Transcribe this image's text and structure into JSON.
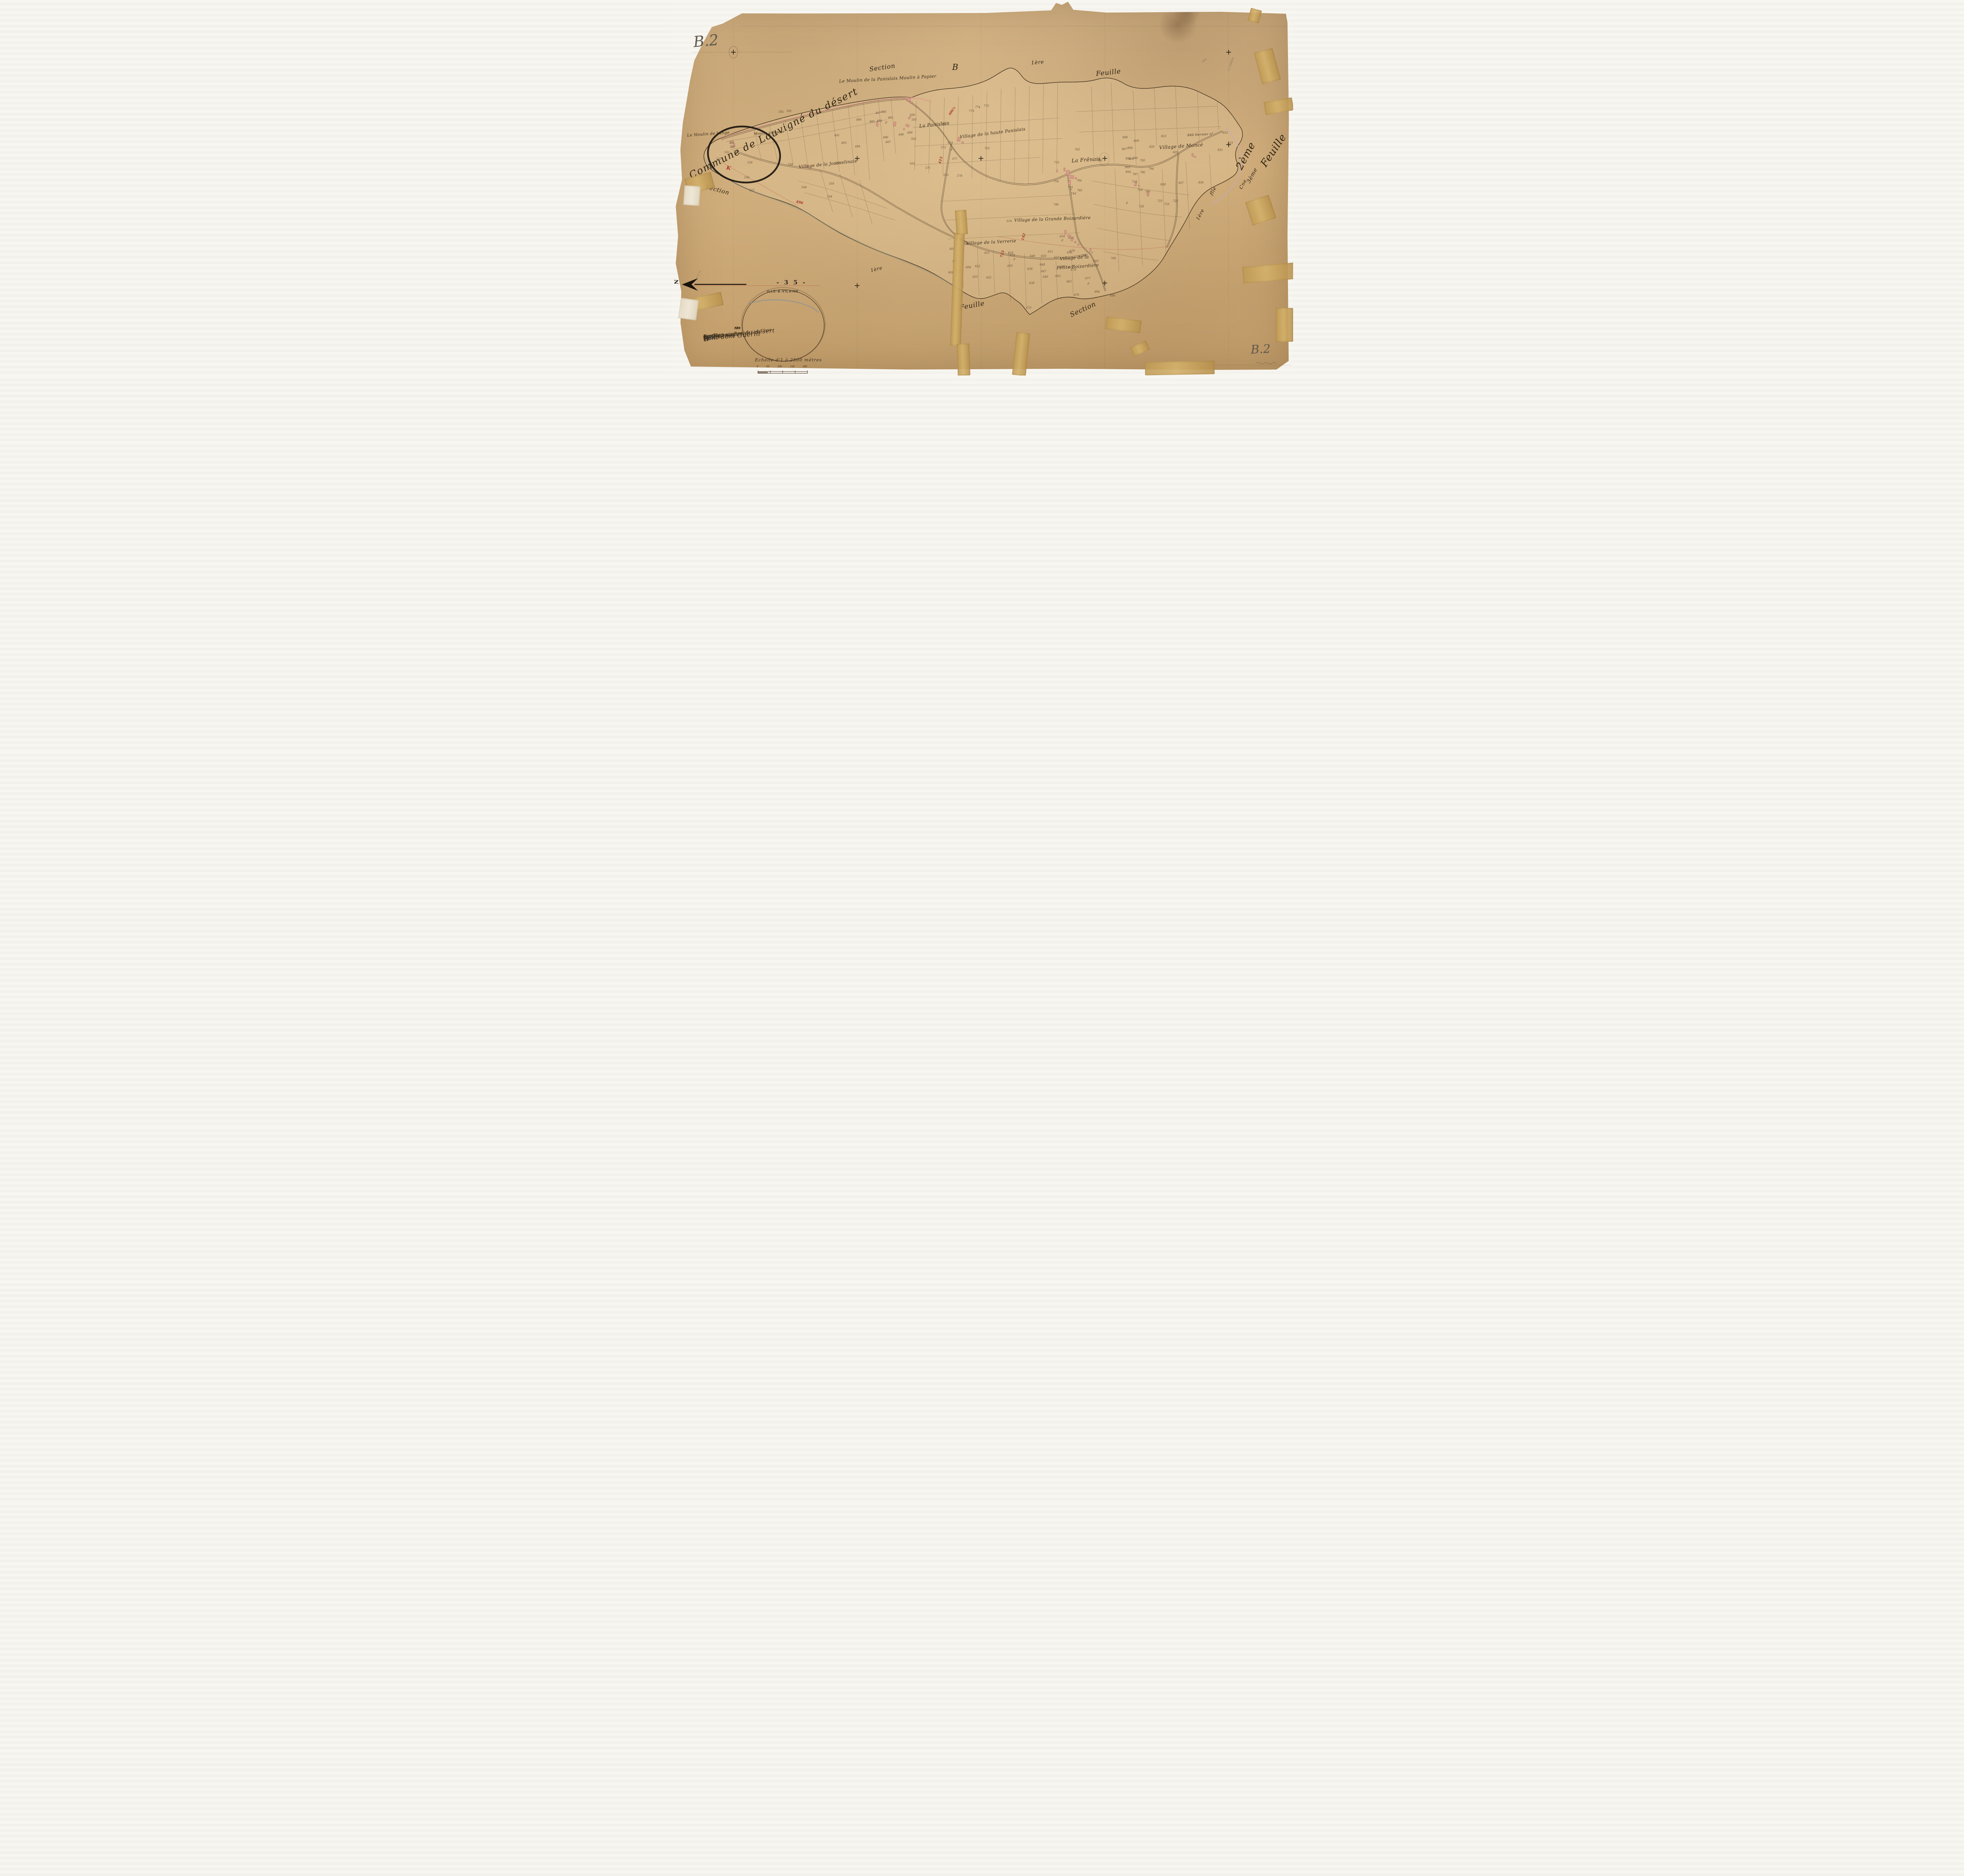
{
  "page": {
    "sheet_label_topleft": "B.2",
    "sheet_label_bottomright": "B.2",
    "archive_number": "- 3 5 -",
    "department_stamp": "ILLE-&-VILAINE",
    "north_label": "N"
  },
  "titles": {
    "commune": "Commune de Louvigné du désert"
  },
  "flourishes": [
    {
      "text": "Section",
      "x": 31.9,
      "y": 16.9,
      "rot": -8,
      "size": 16
    },
    {
      "text": "B",
      "x": 45.2,
      "y": 16.6,
      "rot": 0,
      "size": 21
    },
    {
      "text": "1ère",
      "x": 57.9,
      "y": 15.9,
      "rot": -5,
      "size": 13
    },
    {
      "text": "Feuille",
      "x": 68.3,
      "y": 18.3,
      "rot": -6,
      "size": 17
    },
    {
      "text": "Section",
      "x": 5.5,
      "y": 49.6,
      "rot": 15,
      "size": 15
    },
    {
      "text": "1ère",
      "x": 32.1,
      "y": 70.9,
      "rot": -14,
      "size": 12
    },
    {
      "text": "Feuille",
      "x": 46.4,
      "y": 80.3,
      "rot": -10,
      "size": 17
    },
    {
      "text": "Section",
      "x": 64.0,
      "y": 81.4,
      "rot": -25,
      "size": 17
    },
    {
      "text": "2ème",
      "x": 90.0,
      "y": 40.0,
      "rot": -62,
      "size": 26
    },
    {
      "text": "Feuille",
      "x": 93.9,
      "y": 38.5,
      "rot": -56,
      "size": 26
    },
    {
      "text": "3ème",
      "x": 92.1,
      "y": 45.9,
      "rot": -62,
      "size": 14
    },
    {
      "text": "Cne",
      "x": 91.1,
      "y": 48.3,
      "rot": -62,
      "size": 12
    },
    {
      "text": "1ère",
      "x": 84.1,
      "y": 56.4,
      "rot": -62,
      "size": 12
    },
    {
      "text": "flle",
      "x": 86.4,
      "y": 50.1,
      "rot": -62,
      "size": 12
    }
  ],
  "cartouche": {
    "commune": "La Bazouges du désert",
    "section_word": "Section",
    "section_letter": "B",
    "section_number": "2",
    "dite": "dite du",
    "name": "Pont dom Guérin",
    "feuilles": "En deux feuilles",
    "flle": "2ème flle",
    "range": "du N° 485 au N° 840",
    "author": "Par M. Declaye Gtre de 1ère Clsse",
    "scale_text": "Echelle d'1 à 2500 mètres",
    "scale_ticks": [
      "0",
      "50",
      "100",
      "150",
      "200"
    ]
  },
  "margin_list": {
    "header": "N°s B.",
    "values": [
      "508",
      "539",
      "616",
      "828"
    ]
  },
  "map": {
    "region_labels": [
      {
        "text": "Le Moulin de la Panislais Moulin à Papier",
        "x": 27.0,
        "y": 20.3,
        "rot": -3,
        "size": 11
      },
      {
        "text": "Le Moulin de Lange",
        "x": 2.6,
        "y": 35.1,
        "rot": -4,
        "size": 10
      },
      {
        "text": "Moulin à Papier",
        "x": 13.3,
        "y": 34.9,
        "rot": -4,
        "size": 9
      },
      {
        "text": "La Panislais",
        "x": 39.9,
        "y": 32.4,
        "rot": -6,
        "size": 12
      },
      {
        "text": "Village de la haute Panislais",
        "x": 46.4,
        "y": 34.7,
        "rot": -7,
        "size": 11
      },
      {
        "text": "Village de la Jousselinais",
        "x": 20.5,
        "y": 43.0,
        "rot": -6,
        "size": 11
      },
      {
        "text": "Village de la Verrerie",
        "x": 47.5,
        "y": 63.8,
        "rot": -3,
        "size": 11
      },
      {
        "text": "Village de la Grande Boizardière",
        "x": 55.2,
        "y": 57.6,
        "rot": -2,
        "size": 11
      },
      {
        "text": "Village de la",
        "x": 62.5,
        "y": 68.0,
        "rot": -4,
        "size": 11
      },
      {
        "text": "Petite Boizardière",
        "x": 62.0,
        "y": 70.3,
        "rot": -4,
        "size": 11
      },
      {
        "text": "La Frênais",
        "x": 64.4,
        "y": 41.8,
        "rot": -4,
        "size": 13
      },
      {
        "text": "Village de Moncé",
        "x": 78.5,
        "y": 38.2,
        "rot": -4,
        "size": 12
      },
      {
        "text": "840  Dernier n°",
        "x": 83.0,
        "y": 35.4,
        "rot": -3,
        "size": 8
      }
    ],
    "parcel_numbers": [
      {
        "n": "531",
        "x": 9.8,
        "y": 38.1
      },
      {
        "n": "530",
        "x": 9.9,
        "y": 39.1
      },
      {
        "n": "529",
        "x": 10.5,
        "y": 40.4
      },
      {
        "n": "532",
        "x": 9.0,
        "y": 40.6
      },
      {
        "n": "533",
        "x": 7.7,
        "y": 42.4
      },
      {
        "n": "534",
        "x": 6.3,
        "y": 44.1
      },
      {
        "n": "528",
        "x": 12.7,
        "y": 43.3
      },
      {
        "n": "536",
        "x": 12.2,
        "y": 47.3
      },
      {
        "n": "537",
        "x": 13.0,
        "y": 50.7
      },
      {
        "n": "592",
        "x": 17.7,
        "y": 29.8
      },
      {
        "n": "591",
        "x": 19.0,
        "y": 29.6
      },
      {
        "n": "490",
        "x": 30.2,
        "y": 31.9
      },
      {
        "n": "489",
        "x": 32.3,
        "y": 32.4
      },
      {
        "n": "488",
        "x": 33.5,
        "y": 32.2
      },
      {
        "n": "487",
        "x": 33.3,
        "y": 30.1
      },
      {
        "n": "486",
        "x": 34.2,
        "y": 29.8
      },
      {
        "n": "485",
        "x": 35.3,
        "y": 31.4
      },
      {
        "n": "491",
        "x": 26.7,
        "y": 36.1
      },
      {
        "n": "493",
        "x": 27.8,
        "y": 38.1
      },
      {
        "n": "494",
        "x": 30.0,
        "y": 39.0
      },
      {
        "n": "496",
        "x": 34.5,
        "y": 36.6
      },
      {
        "n": "497",
        "x": 34.9,
        "y": 37.9
      },
      {
        "n": "498",
        "x": 37.0,
        "y": 35.9
      },
      {
        "n": "499",
        "x": 38.4,
        "y": 35.4
      },
      {
        "n": "500",
        "x": 38.8,
        "y": 30.7
      },
      {
        "n": "501",
        "x": 39.1,
        "y": 31.9
      },
      {
        "n": "502",
        "x": 39.0,
        "y": 37.0
      },
      {
        "n": "503",
        "x": 38.8,
        "y": 43.6
      },
      {
        "n": "571",
        "x": 41.3,
        "y": 44.8
      },
      {
        "n": "572",
        "x": 43.8,
        "y": 39.3
      },
      {
        "n": "573",
        "x": 44.2,
        "y": 46.7
      },
      {
        "n": "574",
        "x": 44.9,
        "y": 38.1
      },
      {
        "n": "577",
        "x": 45.6,
        "y": 42.4
      },
      {
        "n": "578",
        "x": 46.4,
        "y": 46.9
      },
      {
        "n": "764",
        "x": 43.9,
        "y": 33.1
      },
      {
        "n": "763",
        "x": 50.8,
        "y": 39.5
      },
      {
        "n": "773",
        "x": 48.3,
        "y": 29.6
      },
      {
        "n": "774",
        "x": 49.3,
        "y": 28.6
      },
      {
        "n": "775",
        "x": 50.7,
        "y": 28.2
      },
      {
        "n": "539",
        "x": 19.2,
        "y": 43.8
      },
      {
        "n": "544",
        "x": 21.4,
        "y": 49.9
      },
      {
        "n": "558",
        "x": 25.5,
        "y": 52.4
      },
      {
        "n": "559",
        "x": 25.8,
        "y": 49.0
      },
      {
        "n": "561",
        "x": 26.8,
        "y": 43.4
      },
      {
        "n": "753",
        "x": 62.0,
        "y": 43.3
      },
      {
        "n": "754",
        "x": 61.9,
        "y": 48.3
      },
      {
        "n": "783",
        "x": 65.3,
        "y": 39.9
      },
      {
        "n": "784",
        "x": 65.6,
        "y": 48.1
      },
      {
        "n": "785",
        "x": 65.7,
        "y": 50.7
      },
      {
        "n": "744",
        "x": 64.7,
        "y": 51.6
      },
      {
        "n": "745",
        "x": 64.2,
        "y": 49.9
      },
      {
        "n": "746",
        "x": 61.9,
        "y": 54.5
      },
      {
        "n": "786",
        "x": 68.9,
        "y": 42.8
      },
      {
        "n": "805",
        "x": 73.5,
        "y": 42.3
      },
      {
        "n": "806",
        "x": 73.8,
        "y": 39.4
      },
      {
        "n": "807",
        "x": 72.9,
        "y": 39.7
      },
      {
        "n": "808",
        "x": 73.0,
        "y": 36.6
      },
      {
        "n": "809",
        "x": 74.8,
        "y": 37.5
      },
      {
        "n": "820",
        "x": 77.3,
        "y": 39.1
      },
      {
        "n": "823",
        "x": 79.2,
        "y": 36.3
      },
      {
        "n": "795",
        "x": 75.8,
        "y": 42.8
      },
      {
        "n": "794",
        "x": 77.2,
        "y": 45.0
      },
      {
        "n": "796",
        "x": 75.8,
        "y": 45.9
      },
      {
        "n": "797",
        "x": 74.6,
        "y": 46.4
      },
      {
        "n": "800",
        "x": 74.6,
        "y": 42.2
      },
      {
        "n": "801",
        "x": 74.0,
        "y": 42.4
      },
      {
        "n": "803",
        "x": 73.4,
        "y": 44.6
      },
      {
        "n": "804",
        "x": 73.5,
        "y": 45.8
      },
      {
        "n": "718",
        "x": 74.5,
        "y": 48.4
      },
      {
        "n": "719",
        "x": 75.4,
        "y": 50.6
      },
      {
        "n": "790",
        "x": 76.6,
        "y": 51.0
      },
      {
        "n": "725",
        "x": 78.6,
        "y": 53.6
      },
      {
        "n": "723",
        "x": 79.7,
        "y": 54.4
      },
      {
        "n": "722",
        "x": 81.1,
        "y": 53.6
      },
      {
        "n": "728",
        "x": 75.6,
        "y": 55.0
      },
      {
        "n": "837",
        "x": 82.0,
        "y": 48.7
      },
      {
        "n": "838",
        "x": 79.1,
        "y": 49.2
      },
      {
        "n": "836",
        "x": 85.2,
        "y": 48.6
      },
      {
        "n": "839",
        "x": 81.1,
        "y": 40.6
      },
      {
        "n": "616",
        "x": 54.4,
        "y": 58.9
      },
      {
        "n": "618",
        "x": 54.9,
        "y": 68.0
      },
      {
        "n": "638",
        "x": 58.0,
        "y": 75.4
      },
      {
        "n": "639",
        "x": 57.7,
        "y": 71.7
      },
      {
        "n": "640",
        "x": 60.2,
        "y": 73.7
      },
      {
        "n": "647",
        "x": 59.9,
        "y": 72.3
      },
      {
        "n": "648",
        "x": 59.7,
        "y": 70.5
      },
      {
        "n": "649",
        "x": 58.1,
        "y": 68.2
      },
      {
        "n": "650",
        "x": 59.9,
        "y": 68.2
      },
      {
        "n": "651",
        "x": 61.0,
        "y": 67.0
      },
      {
        "n": "654",
        "x": 62.9,
        "y": 63.0
      },
      {
        "n": "655",
        "x": 64.3,
        "y": 63.4
      },
      {
        "n": "656",
        "x": 64.1,
        "y": 67.3
      },
      {
        "n": "657",
        "x": 62.0,
        "y": 68.6
      },
      {
        "n": "660",
        "x": 62.9,
        "y": 71.0
      },
      {
        "n": "661",
        "x": 64.3,
        "y": 71.2
      },
      {
        "n": "662",
        "x": 64.0,
        "y": 75.0
      },
      {
        "n": "663",
        "x": 62.2,
        "y": 73.5
      },
      {
        "n": "605",
        "x": 45.2,
        "y": 66.3
      },
      {
        "n": "606",
        "x": 45.7,
        "y": 69.6
      },
      {
        "n": "607",
        "x": 46.3,
        "y": 72.1
      },
      {
        "n": "601",
        "x": 45.0,
        "y": 72.6
      },
      {
        "n": "608",
        "x": 47.8,
        "y": 71.2
      },
      {
        "n": "609",
        "x": 47.5,
        "y": 65.1
      },
      {
        "n": "621",
        "x": 50.8,
        "y": 67.4
      },
      {
        "n": "622",
        "x": 49.3,
        "y": 70.9
      },
      {
        "n": "623",
        "x": 48.9,
        "y": 73.7
      },
      {
        "n": "625",
        "x": 51.1,
        "y": 74.0
      },
      {
        "n": "619",
        "x": 54.6,
        "y": 67.4
      },
      {
        "n": "620",
        "x": 54.5,
        "y": 70.8
      },
      {
        "n": "676",
        "x": 65.2,
        "y": 78.6
      },
      {
        "n": "677",
        "x": 67.0,
        "y": 74.2
      },
      {
        "n": "678",
        "x": 64.7,
        "y": 71.9
      },
      {
        "n": "679",
        "x": 64.5,
        "y": 66.8
      },
      {
        "n": "692",
        "x": 66.6,
        "y": 68.1
      },
      {
        "n": "693",
        "x": 68.3,
        "y": 69.6
      },
      {
        "n": "694",
        "x": 68.5,
        "y": 77.7
      },
      {
        "n": "696",
        "x": 71.0,
        "y": 78.8
      },
      {
        "n": "700",
        "x": 71.1,
        "y": 68.8
      },
      {
        "n": "831",
        "x": 88.3,
        "y": 40.0
      },
      {
        "n": "832",
        "x": 89.1,
        "y": 35.4
      },
      {
        "n": "833",
        "x": 89.9,
        "y": 38.1
      },
      {
        "n": "673",
        "x": 57.5,
        "y": 82.0
      },
      {
        "n": "P",
        "x": 34.6,
        "y": 32.7
      },
      {
        "n": "P",
        "x": 45.1,
        "y": 40.0
      },
      {
        "n": "P",
        "x": 62.9,
        "y": 64.1
      },
      {
        "n": "P",
        "x": 67.1,
        "y": 75.6
      },
      {
        "n": "P",
        "x": 55.2,
        "y": 69.1
      },
      {
        "n": "P",
        "x": 64.3,
        "y": 50.6
      },
      {
        "n": "P",
        "x": 73.3,
        "y": 54.2
      }
    ],
    "red_annotations": [
      {
        "text": "K",
        "x": 8.9,
        "y": 44.0,
        "rot": 10,
        "size": 13
      },
      {
        "text": "486½",
        "x": 44.4,
        "y": 29.0,
        "rot": -55,
        "size": 8
      },
      {
        "text": "415",
        "x": 42.8,
        "y": 42.2,
        "rot": -75,
        "size": 9
      },
      {
        "text": "142",
        "x": 56.1,
        "y": 62.6,
        "rot": -75,
        "size": 9
      },
      {
        "text": "723",
        "x": 52.7,
        "y": 67.2,
        "rot": -75,
        "size": 9
      },
      {
        "text": "496",
        "x": 20.1,
        "y": 53.4,
        "rot": 12,
        "size": 9
      }
    ],
    "margin_notes": [
      {
        "text": "des",
        "x": 85.3,
        "y": 15.6,
        "rot": -40,
        "size": 8
      },
      {
        "text": "à 1000m",
        "x": 88.9,
        "y": 16.5,
        "rot": -70,
        "size": 8
      },
      {
        "text": "N°1 ½",
        "x": 3.6,
        "y": 72.8,
        "rot": -70,
        "size": 8
      }
    ]
  }
}
